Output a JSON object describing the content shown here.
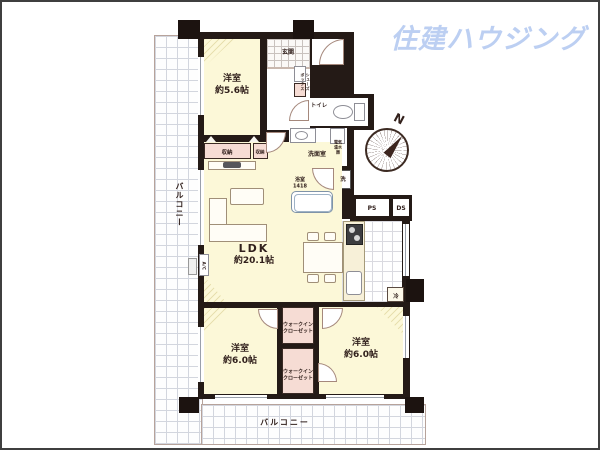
{
  "logo": {
    "text": "住建ハウジング",
    "color": "#bccff2"
  },
  "compass": {
    "north_label": "N"
  },
  "floorplan": {
    "balcony_left": "バルコニー",
    "balcony_bottom": "バルコニー",
    "entrance": "玄関",
    "shoe_box": "シューズボックス",
    "toilet": "トイレ",
    "washroom": "洗面室",
    "water_heater": "電気温水器",
    "bathroom_name": "浴室",
    "bathroom_size": "1418",
    "washer": "洗",
    "ps": "PS",
    "ds": "DS",
    "fridge": "冷",
    "ac": "A/C",
    "storage1": "収納",
    "storage2": "収納",
    "ldk_name": "LDK",
    "ldk_size": "約20.1帖",
    "bedroom1_name": "洋室",
    "bedroom1_size": "約5.6帖",
    "bedroom2_name": "洋室",
    "bedroom2_size": "約6.0帖",
    "bedroom3_name": "洋室",
    "bedroom3_size": "約6.0帖",
    "wic_line1": "ウォークイン",
    "wic_line2": "クローゼット"
  },
  "colors": {
    "wall": "#241a16",
    "room_yellow": "#fcf8d8",
    "closet_pink": "#f6dcd4",
    "bath_blue": "#d5e4f4",
    "logo_blue": "#bccff2"
  }
}
